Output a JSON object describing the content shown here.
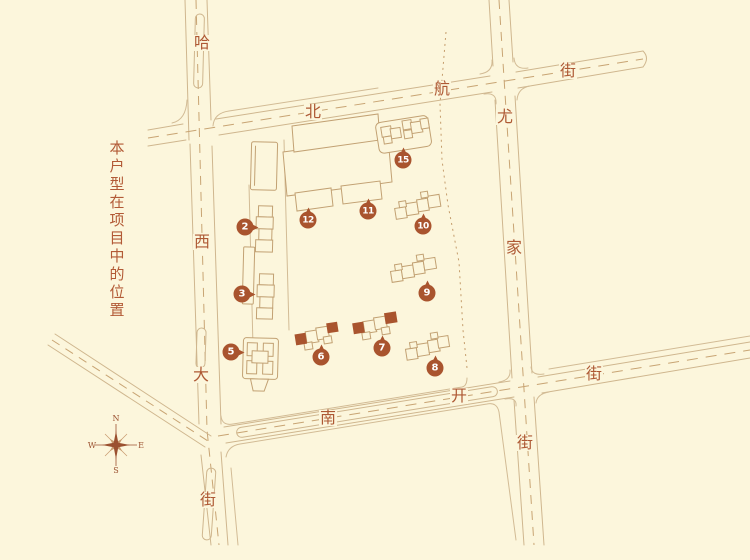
{
  "note": {
    "text": "本户型在项目中的位置"
  },
  "colors": {
    "background": "#FCF6DC",
    "street_line": "#CFB68E",
    "block_line": "#D2BB95",
    "dash_line": "#C8A473",
    "accent": "#A9542E",
    "label_text": "#AE5934"
  },
  "compass": {
    "north": "N",
    "east": "E",
    "south": "S",
    "west": "W"
  },
  "streets": {
    "haxi": {
      "name": "哈西大街",
      "chars": [
        {
          "t": "哈",
          "x": 202,
          "y": 43
        },
        {
          "t": "西",
          "x": 202,
          "y": 242
        },
        {
          "t": "大",
          "x": 201,
          "y": 375
        },
        {
          "t": "街",
          "x": 208,
          "y": 500
        }
      ]
    },
    "beihang": {
      "name": "北航街",
      "chars": [
        {
          "t": "北",
          "x": 313,
          "y": 112
        },
        {
          "t": "航",
          "x": 442,
          "y": 89
        },
        {
          "t": "街",
          "x": 568,
          "y": 71
        }
      ]
    },
    "youjia": {
      "name": "尤家街",
      "chars": [
        {
          "t": "尤",
          "x": 505,
          "y": 117
        },
        {
          "t": "家",
          "x": 514,
          "y": 248
        },
        {
          "t": "街",
          "x": 525,
          "y": 443
        }
      ]
    },
    "nankai": {
      "name": "南开街",
      "chars": [
        {
          "t": "南",
          "x": 328,
          "y": 418
        },
        {
          "t": "开",
          "x": 459,
          "y": 396
        },
        {
          "t": "街",
          "x": 594,
          "y": 374
        }
      ]
    }
  },
  "markers": [
    {
      "label": "2",
      "x": 245,
      "y": 227,
      "tail": "right"
    },
    {
      "label": "3",
      "x": 242,
      "y": 294,
      "tail": "right"
    },
    {
      "label": "5",
      "x": 231,
      "y": 352,
      "tail": "right"
    },
    {
      "label": "6",
      "x": 321,
      "y": 357,
      "tail": "up"
    },
    {
      "label": "7",
      "x": 382,
      "y": 348,
      "tail": "up"
    },
    {
      "label": "8",
      "x": 435,
      "y": 368,
      "tail": "up"
    },
    {
      "label": "9",
      "x": 427,
      "y": 293,
      "tail": "up"
    },
    {
      "label": "10",
      "x": 423,
      "y": 226,
      "tail": "up"
    },
    {
      "label": "11",
      "x": 368,
      "y": 211,
      "tail": "up"
    },
    {
      "label": "12",
      "x": 308,
      "y": 220,
      "tail": "up"
    },
    {
      "label": "15",
      "x": 403,
      "y": 160,
      "tail": "up"
    }
  ],
  "highlighted_buildings": [
    "6",
    "7"
  ]
}
